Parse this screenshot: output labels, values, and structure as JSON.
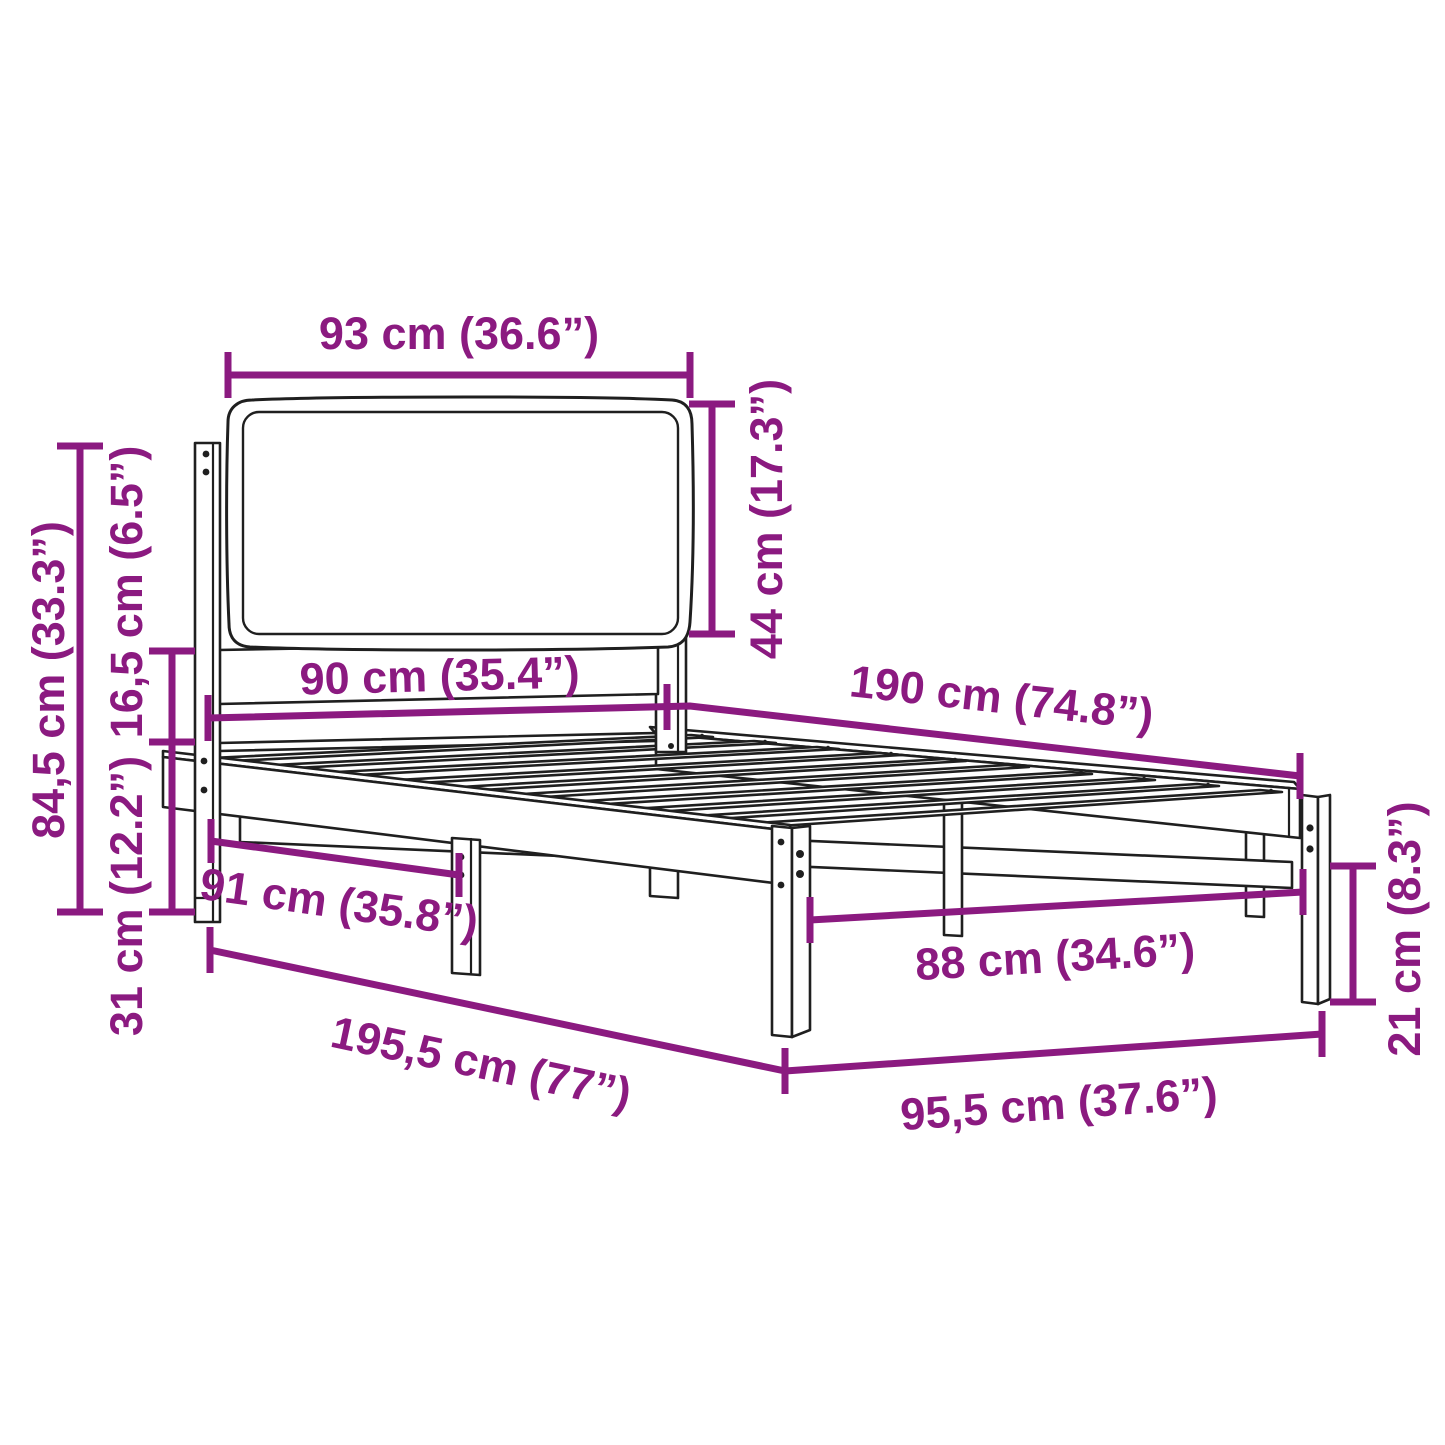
{
  "diagram": {
    "type": "product-dimension-diagram",
    "subject": "bed-frame-with-upholstered-headboard",
    "background_color": "#FFFFFF",
    "dimension_color": "#8B1A80",
    "drawing_color": "#1F1F1F",
    "dimensions": [
      {
        "id": "headboard-width",
        "label": "93 cm (36.6”)",
        "orientation": "horizontal"
      },
      {
        "id": "headboard-panel-height",
        "label": "44 cm (17.3”)",
        "orientation": "vertical"
      },
      {
        "id": "total-height",
        "label": "84,5 cm (33.3”)",
        "orientation": "vertical"
      },
      {
        "id": "headboard-lower-gap",
        "label": "16,5 cm (6.5”)",
        "orientation": "vertical"
      },
      {
        "id": "frame-top-height",
        "label": "31 cm (12.2”)",
        "orientation": "vertical"
      },
      {
        "id": "mattress-width",
        "label": "90 cm (35.4”)",
        "orientation": "horizontal"
      },
      {
        "id": "mattress-length",
        "label": "190 cm (74.8”)",
        "orientation": "slanted"
      },
      {
        "id": "headboard-side-length",
        "label": "91 cm (35.8”)",
        "orientation": "slanted"
      },
      {
        "id": "inner-width",
        "label": "88 cm (34.6”)",
        "orientation": "slanted"
      },
      {
        "id": "total-length",
        "label": "195,5 cm (77”)",
        "orientation": "slanted"
      },
      {
        "id": "total-width",
        "label": "95,5 cm (37.6”)",
        "orientation": "slanted"
      },
      {
        "id": "leg-height",
        "label": "21 cm (8.3”)",
        "orientation": "vertical"
      }
    ]
  }
}
